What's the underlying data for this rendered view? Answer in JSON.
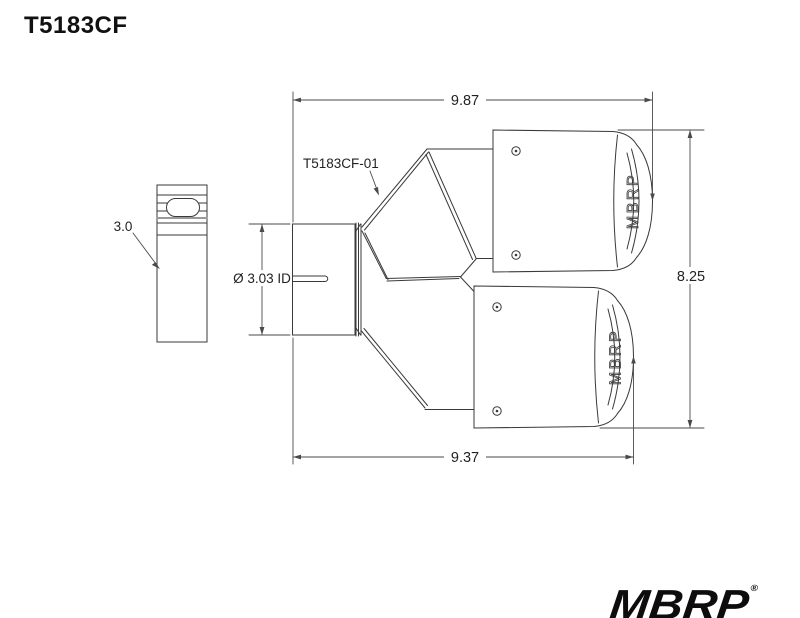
{
  "page": {
    "title": "T5183CF"
  },
  "drawing": {
    "part_label": "T5183CF-01",
    "dimensions": {
      "top_width": "9.87",
      "bottom_width": "9.37",
      "height": "8.25",
      "inlet_length": "3.0",
      "inlet_diameter": "Ø 3.03 ID"
    },
    "tip_brand_text": "MBRP"
  },
  "logo": {
    "text": "MBRP",
    "registered_mark": "®"
  },
  "colors": {
    "line": "#3a3a3a",
    "dimension_line": "#4a4a4a",
    "background": "#ffffff",
    "text": "#222222"
  }
}
